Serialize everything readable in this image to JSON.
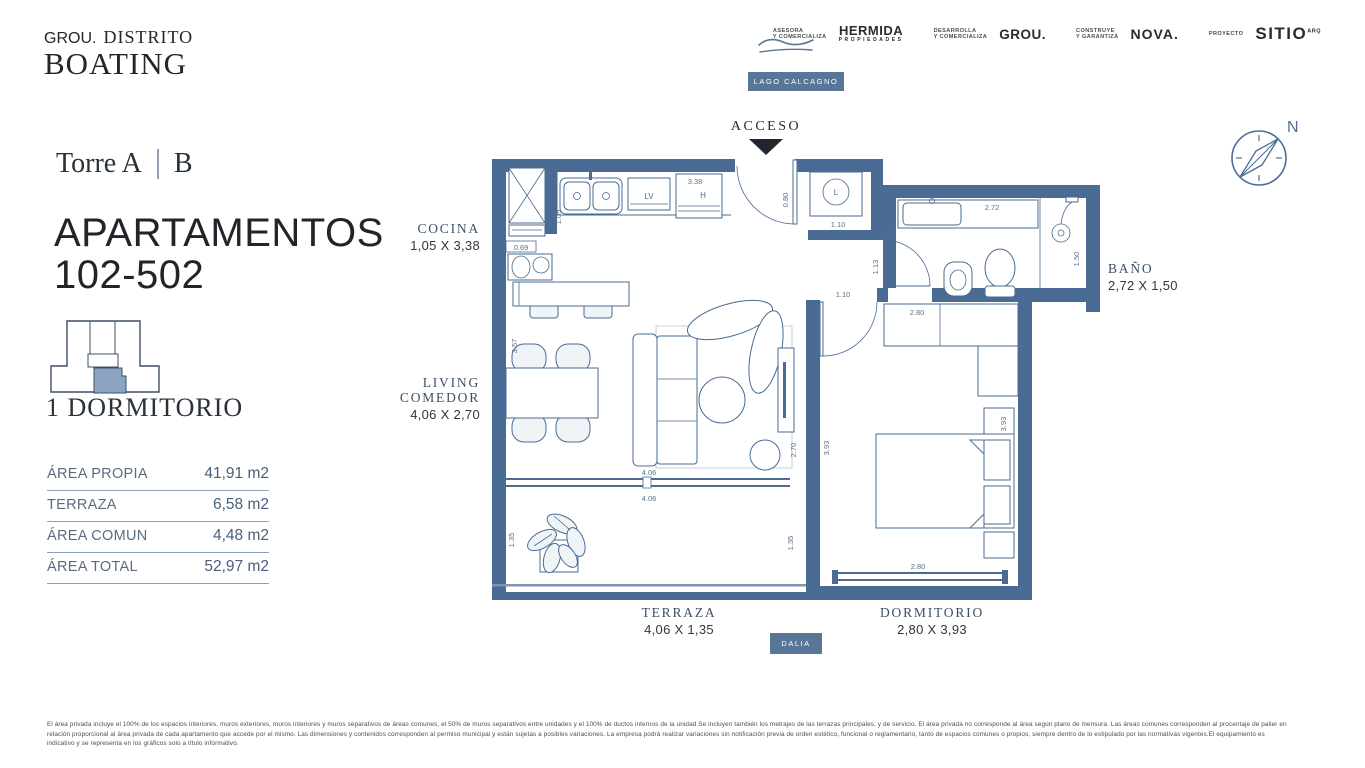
{
  "brand": {
    "grou": "GROU.",
    "distrito": "DISTRITO",
    "boating": "BOATING"
  },
  "partners": [
    {
      "role": "ASESORA\nY COMERCIALIZA",
      "name": "HERMIDA",
      "sub": "PROPIEDADES"
    },
    {
      "role": "DESARROLLA\nY COMERCIALIZA",
      "name": "GROU."
    },
    {
      "role": "CONSTRUYE\nY GARANTIZA",
      "name": "NOVA."
    },
    {
      "role": "PROYECTO",
      "name": "SITIO",
      "sup": "ARQ"
    }
  ],
  "map": {
    "lake_label": "LAGO CALCAGNO",
    "street_label": "DALIA",
    "access_label": "ACCESO",
    "north_label": "N"
  },
  "unit": {
    "tower": "Torre A",
    "tower_alt": "B",
    "title_line1": "APARTAMENTOS",
    "title_line2": "102-502",
    "bedrooms": "1 DORMITORIO"
  },
  "areas": {
    "rows": [
      {
        "label": "ÁREA PROPIA",
        "value": "41,91 m2"
      },
      {
        "label": "TERRAZA",
        "value": "6,58 m2"
      },
      {
        "label": "ÁREA COMUN",
        "value": "4,48 m2"
      },
      {
        "label": "ÁREA TOTAL",
        "value": "52,97 m2"
      }
    ]
  },
  "rooms": [
    {
      "name": "COCINA",
      "dims": "1,05 X 3,38"
    },
    {
      "name": "LIVING COMEDOR",
      "dims": "4,06 X 2,70"
    },
    {
      "name": "BAÑO",
      "dims": "2,72 X 1,50"
    },
    {
      "name": "TERRAZA",
      "dims": "4,06 X 1,35"
    },
    {
      "name": "DORMITORIO",
      "dims": "2,80 X 3,93"
    }
  ],
  "plan": {
    "appliances": {
      "lv": "LV",
      "h": "H",
      "l": "L"
    },
    "dims": {
      "d338": "3.38",
      "d105": "1.05",
      "d069": "0.69",
      "d080": "0.80",
      "d110a": "1.10",
      "d150a": "1.50",
      "d272": "2.72",
      "d150b": "1.50",
      "d113": "1.13",
      "d110b": "1.10",
      "d280a": "2.80",
      "d357": "3.57",
      "d270": "2.70",
      "d393a": "3.93",
      "d393b": "3.93",
      "d406a": "4.06",
      "d406b": "4.06",
      "d135a": "1.35",
      "d135b": "1.35",
      "d280b": "2.80"
    }
  },
  "disclaimer": {
    "line1": "El área privada incluye el 100% de los espacios interiores, muros exteriores, muros interiores y muros separativos de áreas comunes, el 50% de muros separativos entre unidades y el 100% de ductos internos de la unidad.Se incluyen también los metrajes de las terrazas principales, y de servicio. El área privada no corresponde al área según plano de mensura. Las áreas comunes corresponden al procentaje de palier en",
    "line2": "relación proporcional al área privada de cada apartamento que accede por el mismo. Las dimensiones y contenidos corresponden al permiso municipal y están sujetas a posibles variaciones. La empresa podrá realizar variaciones sin notificación previa de orden estético, funcional o reglamentario, tanto de espacios comunes o propios, siempre dentro de lo estipulado por las normativas vigentes.El equipamiento es",
    "line3": "indicativo y se representa en los gráficos solo a título informativo."
  },
  "colors": {
    "wall": "#4a6b94",
    "accent": "#587697",
    "ink": "#23262a",
    "dim_text": "#5d7086",
    "room_label": "#3e5066"
  }
}
